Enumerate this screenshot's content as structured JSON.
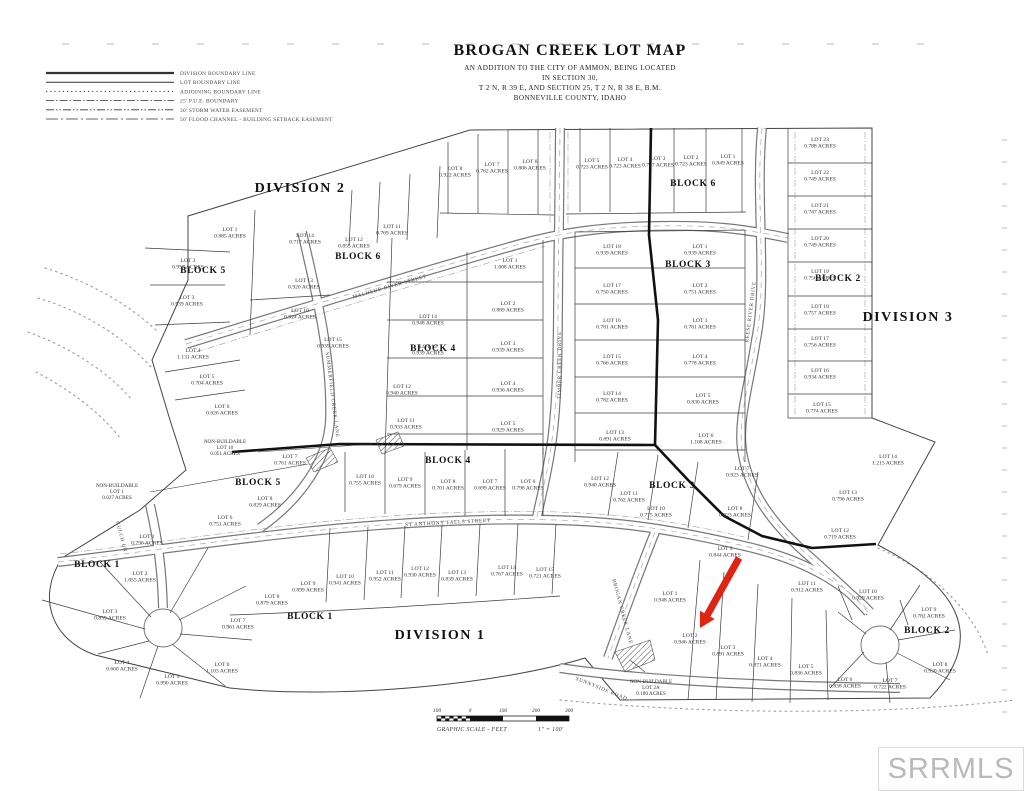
{
  "title": {
    "line1": "BROGAN CREEK LOT MAP",
    "line2": "AN ADDITION TO THE CITY OF AMMON, BEING LOCATED",
    "line3": "IN SECTION 30,",
    "line4": "T 2 N, R 39 E, AND SECTION 25, T 2 N, R 38 E, B.M.",
    "line5": "BONNEVILLE COUNTY, IDAHO"
  },
  "legend": {
    "items": [
      {
        "label": "DIVISION BOUNDARY LINE",
        "dash": "heavy"
      },
      {
        "label": "LOT BOUNDARY LINE",
        "dash": "solid"
      },
      {
        "label": "ADJOINING BOUNDARY LINE",
        "dash": "dotted"
      },
      {
        "label": "25' P.U.E. BOUNDARY",
        "dash": "dashdot"
      },
      {
        "label": "30' STORM WATER EASEMENT",
        "dash": "dashdotdot"
      },
      {
        "label": "50' FLOOD CHANNEL - BUILDING SETBACK EASEMENT",
        "dash": "longdash"
      }
    ]
  },
  "watermark": {
    "text": "SRRMLS"
  },
  "scalebar": {
    "ticks": [
      "100",
      "0",
      "100",
      "200",
      "300"
    ],
    "caption_left": "GRAPHIC SCALE - FEET",
    "caption_right": "1\" = 100'"
  },
  "arrow": {
    "color": "#e02412",
    "target": "LOT 2 BLOCK 2"
  },
  "divisions": [
    {
      "label": "DIVISION 2",
      "x": 300,
      "y": 192
    },
    {
      "label": "DIVISION 3",
      "x": 908,
      "y": 321
    },
    {
      "label": "DIVISION 1",
      "x": 440,
      "y": 639
    }
  ],
  "blocks": [
    {
      "label": "BLOCK 5",
      "x": 203,
      "y": 273
    },
    {
      "label": "BLOCK 6",
      "x": 358,
      "y": 259
    },
    {
      "label": "BLOCK 6",
      "x": 693,
      "y": 186
    },
    {
      "label": "BLOCK 3",
      "x": 688,
      "y": 267
    },
    {
      "label": "BLOCK 2",
      "x": 838,
      "y": 281
    },
    {
      "label": "BLOCK 4",
      "x": 433,
      "y": 351
    },
    {
      "label": "BLOCK 4",
      "x": 448,
      "y": 463
    },
    {
      "label": "BLOCK 5",
      "x": 258,
      "y": 485
    },
    {
      "label": "BLOCK 3",
      "x": 672,
      "y": 488
    },
    {
      "label": "BLOCK 1",
      "x": 97,
      "y": 567
    },
    {
      "label": "BLOCK 1",
      "x": 310,
      "y": 619
    },
    {
      "label": "BLOCK 2",
      "x": 927,
      "y": 633
    }
  ],
  "streets": [
    {
      "name": "MALHEUR RIVER STREET",
      "x": 390,
      "y": 288,
      "rot": -16
    },
    {
      "name": "TIMBER CREEK DRIVE",
      "x": 561,
      "y": 365,
      "rot": -90
    },
    {
      "name": "REESE RIVER DRIVE",
      "x": 752,
      "y": 312,
      "rot": -83
    },
    {
      "name": "ST ANTHONY FALLS STREET",
      "x": 448,
      "y": 524,
      "rot": -3
    },
    {
      "name": "SUMMERFIELD CREEK LANE",
      "x": 331,
      "y": 395,
      "rot": 83
    },
    {
      "name": "BROGAN CREEK LANE",
      "x": 621,
      "y": 612,
      "rot": 75
    },
    {
      "name": "SUNNYSIDE ROAD",
      "x": 601,
      "y": 690,
      "rot": 22
    },
    {
      "name": "GULCH LN",
      "x": 120,
      "y": 537,
      "rot": 75
    }
  ],
  "lots": [
    {
      "n": "LOT 8",
      "a": "0.922 ACRES",
      "x": 455,
      "y": 170
    },
    {
      "n": "LOT 7",
      "a": "0.762 ACRES",
      "x": 492,
      "y": 166
    },
    {
      "n": "LOT 6",
      "a": "0.806 ACRES",
      "x": 530,
      "y": 163
    },
    {
      "n": "LOT 5",
      "a": "0.723 ACRES",
      "x": 592,
      "y": 162
    },
    {
      "n": "LOT 4",
      "a": "0.723 ACRES",
      "x": 625,
      "y": 161
    },
    {
      "n": "LOT 3",
      "a": "0.727 ACRES",
      "x": 658,
      "y": 160
    },
    {
      "n": "LOT 2",
      "a": "0.723 ACRES",
      "x": 691,
      "y": 159
    },
    {
      "n": "LOT 1",
      "a": "0.849 ACRES",
      "x": 728,
      "y": 158
    },
    {
      "n": "LOT 23",
      "a": "0.788 ACRES",
      "x": 820,
      "y": 141
    },
    {
      "n": "LOT 22",
      "a": "0.749 ACRES",
      "x": 820,
      "y": 174
    },
    {
      "n": "LOT 21",
      "a": "0.747 ACRES",
      "x": 820,
      "y": 207
    },
    {
      "n": "LOT 20",
      "a": "0.749 ACRES",
      "x": 820,
      "y": 240
    },
    {
      "n": "LOT 19",
      "a": "0.756 ACRES",
      "x": 820,
      "y": 273
    },
    {
      "n": "LOT 18",
      "a": "0.757 ACRES",
      "x": 820,
      "y": 308
    },
    {
      "n": "LOT 17",
      "a": "0.756 ACRES",
      "x": 820,
      "y": 340
    },
    {
      "n": "LOT 16",
      "a": "0.934 ACRES",
      "x": 820,
      "y": 372
    },
    {
      "n": "LOT 15",
      "a": "0.774 ACRES",
      "x": 822,
      "y": 406
    },
    {
      "n": "LOT 14",
      "a": "1.215 ACRES",
      "x": 888,
      "y": 458
    },
    {
      "n": "LOT 13",
      "a": "0.796 ACRES",
      "x": 848,
      "y": 494
    },
    {
      "n": "LOT 12",
      "a": "0.719 ACRES",
      "x": 840,
      "y": 532
    },
    {
      "n": "LOT 18",
      "a": "0.939 ACRES",
      "x": 612,
      "y": 248
    },
    {
      "n": "LOT 1",
      "a": "0.939 ACRES",
      "x": 700,
      "y": 248
    },
    {
      "n": "LOT 17",
      "a": "0.750 ACRES",
      "x": 612,
      "y": 287
    },
    {
      "n": "LOT 2",
      "a": "0.751 ACRES",
      "x": 700,
      "y": 287
    },
    {
      "n": "LOT 16",
      "a": "0.781 ACRES",
      "x": 612,
      "y": 322
    },
    {
      "n": "LOT 3",
      "a": "0.781 ACRES",
      "x": 700,
      "y": 322
    },
    {
      "n": "LOT 15",
      "a": "0.766 ACRES",
      "x": 612,
      "y": 358
    },
    {
      "n": "LOT 4",
      "a": "0.778 ACRES",
      "x": 700,
      "y": 358
    },
    {
      "n": "LOT 14",
      "a": "0.782 ACRES",
      "x": 612,
      "y": 395
    },
    {
      "n": "LOT 5",
      "a": "0.830 ACRES",
      "x": 703,
      "y": 397
    },
    {
      "n": "LOT 13",
      "a": "0.891 ACRES",
      "x": 615,
      "y": 434
    },
    {
      "n": "LOT 6",
      "a": "1.108 ACRES",
      "x": 706,
      "y": 437
    },
    {
      "n": "LOT 12",
      "a": "0.940 ACRES",
      "x": 600,
      "y": 480
    },
    {
      "n": "LOT 11",
      "a": "0.762 ACRES",
      "x": 629,
      "y": 495
    },
    {
      "n": "LOT 10",
      "a": "0.775 ACRES",
      "x": 656,
      "y": 510
    },
    {
      "n": "LOT 7",
      "a": "0.923 ACRES",
      "x": 742,
      "y": 470
    },
    {
      "n": "LOT 8",
      "a": "0.923 ACRES",
      "x": 735,
      "y": 510
    },
    {
      "n": "LOT 9",
      "a": "0.844 ACRES",
      "x": 725,
      "y": 550
    },
    {
      "n": "LOT 1",
      "a": "1.008 ACRES",
      "x": 510,
      "y": 262
    },
    {
      "n": "LOT 2",
      "a": "0.889 ACRES",
      "x": 508,
      "y": 305
    },
    {
      "n": "LOT 3",
      "a": "0.939 ACRES",
      "x": 508,
      "y": 345
    },
    {
      "n": "LOT 4",
      "a": "0.936 ACRES",
      "x": 508,
      "y": 385
    },
    {
      "n": "LOT 5",
      "a": "0.929 ACRES",
      "x": 508,
      "y": 425
    },
    {
      "n": "LOT 14",
      "a": "0.948 ACRES",
      "x": 428,
      "y": 318
    },
    {
      "n": "LOT 13",
      "a": "0.939 ACRES",
      "x": 428,
      "y": 348
    },
    {
      "n": "LOT 12",
      "a": "0.940 ACRES",
      "x": 402,
      "y": 388
    },
    {
      "n": "LOT 11",
      "a": "0.933 ACRES",
      "x": 406,
      "y": 422
    },
    {
      "n": "LOT 10",
      "a": "0.755 ACRES",
      "x": 365,
      "y": 478
    },
    {
      "n": "LOT 9",
      "a": "0.679 ACRES",
      "x": 405,
      "y": 481
    },
    {
      "n": "LOT 8",
      "a": "0.701 ACRES",
      "x": 448,
      "y": 483
    },
    {
      "n": "LOT 7",
      "a": "0.699 ACRES",
      "x": 490,
      "y": 483
    },
    {
      "n": "LOT 6",
      "a": "0.798 ACRES",
      "x": 528,
      "y": 483
    },
    {
      "n": "LOT 14",
      "a": "0.717 ACRES",
      "x": 305,
      "y": 237
    },
    {
      "n": "LOT 12",
      "a": "0.855 ACRES",
      "x": 354,
      "y": 241
    },
    {
      "n": "LOT 11",
      "a": "0.769 ACRES",
      "x": 392,
      "y": 228
    },
    {
      "n": "LOT 13",
      "a": "0.920 ACRES",
      "x": 304,
      "y": 282
    },
    {
      "n": "LOT 10",
      "a": "0.924 ACRES",
      "x": 300,
      "y": 312
    },
    {
      "n": "LOT 15",
      "a": "0.939 ACRES",
      "x": 333,
      "y": 341
    },
    {
      "n": "LOT 1",
      "a": "0.885 ACRES",
      "x": 230,
      "y": 231
    },
    {
      "n": "LOT 2",
      "a": "0.957 ACRES",
      "x": 188,
      "y": 262
    },
    {
      "n": "LOT 3",
      "a": "0.939 ACRES",
      "x": 187,
      "y": 299
    },
    {
      "n": "LOT 4",
      "a": "1.131 ACRES",
      "x": 193,
      "y": 352
    },
    {
      "n": "LOT 5",
      "a": "0.704 ACRES",
      "x": 207,
      "y": 378
    },
    {
      "n": "LOT 6",
      "a": "0.626 ACRES",
      "x": 222,
      "y": 408
    },
    {
      "n": "LOT 7",
      "a": "0.761 ACRES",
      "x": 290,
      "y": 458
    },
    {
      "n": "LOT 8",
      "a": "0.829 ACRES",
      "x": 265,
      "y": 500
    },
    {
      "n": "LOT 6",
      "a": "0.751 ACRES",
      "x": 225,
      "y": 519
    },
    {
      "n": "LOT 1",
      "a": "0.796 ACRES",
      "x": 147,
      "y": 538
    },
    {
      "n": "LOT 2",
      "a": "1.055 ACRES",
      "x": 140,
      "y": 575
    },
    {
      "n": "LOT 3",
      "a": "0.859 ACRES",
      "x": 110,
      "y": 613
    },
    {
      "n": "LOT 4",
      "a": "0.660 ACRES",
      "x": 122,
      "y": 664
    },
    {
      "n": "LOT 5",
      "a": "0.990 ACRES",
      "x": 172,
      "y": 678
    },
    {
      "n": "LOT 6",
      "a": "1.103 ACRES",
      "x": 222,
      "y": 666
    },
    {
      "n": "LOT 7",
      "a": "0.961 ACRES",
      "x": 238,
      "y": 622
    },
    {
      "n": "LOT 8",
      "a": "0.879 ACRES",
      "x": 272,
      "y": 598
    },
    {
      "n": "LOT 9",
      "a": "0.899 ACRES",
      "x": 308,
      "y": 585
    },
    {
      "n": "LOT 10",
      "a": "0.941 ACRES",
      "x": 345,
      "y": 578
    },
    {
      "n": "LOT 11",
      "a": "0.952 ACRES",
      "x": 385,
      "y": 574
    },
    {
      "n": "LOT 12",
      "a": "0.930 ACRES",
      "x": 420,
      "y": 570
    },
    {
      "n": "LOT 13",
      "a": "0.839 ACRES",
      "x": 457,
      "y": 574
    },
    {
      "n": "LOT 14",
      "a": "0.767 ACRES",
      "x": 507,
      "y": 569
    },
    {
      "n": "LOT 15",
      "a": "0.721 ACRES",
      "x": 545,
      "y": 571
    },
    {
      "n": "LOT 1",
      "a": "0.948 ACRES",
      "x": 670,
      "y": 595
    },
    {
      "n": "LOT 2",
      "a": "0.946 ACRES",
      "x": 690,
      "y": 637
    },
    {
      "n": "LOT 3",
      "a": "0.891 ACRES",
      "x": 728,
      "y": 649
    },
    {
      "n": "LOT 4",
      "a": "0.871 ACRES",
      "x": 765,
      "y": 660
    },
    {
      "n": "LOT 5",
      "a": "0.836 ACRES",
      "x": 806,
      "y": 668
    },
    {
      "n": "LOT 6",
      "a": "0.838 ACRES",
      "x": 845,
      "y": 681
    },
    {
      "n": "LOT 7",
      "a": "0.722 ACRES",
      "x": 890,
      "y": 682
    },
    {
      "n": "LOT 8",
      "a": "0.930 ACRES",
      "x": 940,
      "y": 666
    },
    {
      "n": "LOT 9",
      "a": "0.782 ACRES",
      "x": 929,
      "y": 611
    },
    {
      "n": "LOT 10",
      "a": "0.929 ACRES",
      "x": 868,
      "y": 593
    },
    {
      "n": "LOT 11",
      "a": "0.912 ACRES",
      "x": 807,
      "y": 585
    }
  ],
  "notes": [
    {
      "lines": [
        "NON-BUILDABLE",
        "LOT 10",
        "0.051 ACRES"
      ],
      "x": 225,
      "y": 443
    },
    {
      "lines": [
        "NON-BUILDABLE",
        "LOT 1",
        "0.027 ACRES"
      ],
      "x": 117,
      "y": 487
    },
    {
      "lines": [
        "NON-BUILDABLE",
        "LOT 2A",
        "0.180 ACRES"
      ],
      "x": 651,
      "y": 683
    }
  ]
}
